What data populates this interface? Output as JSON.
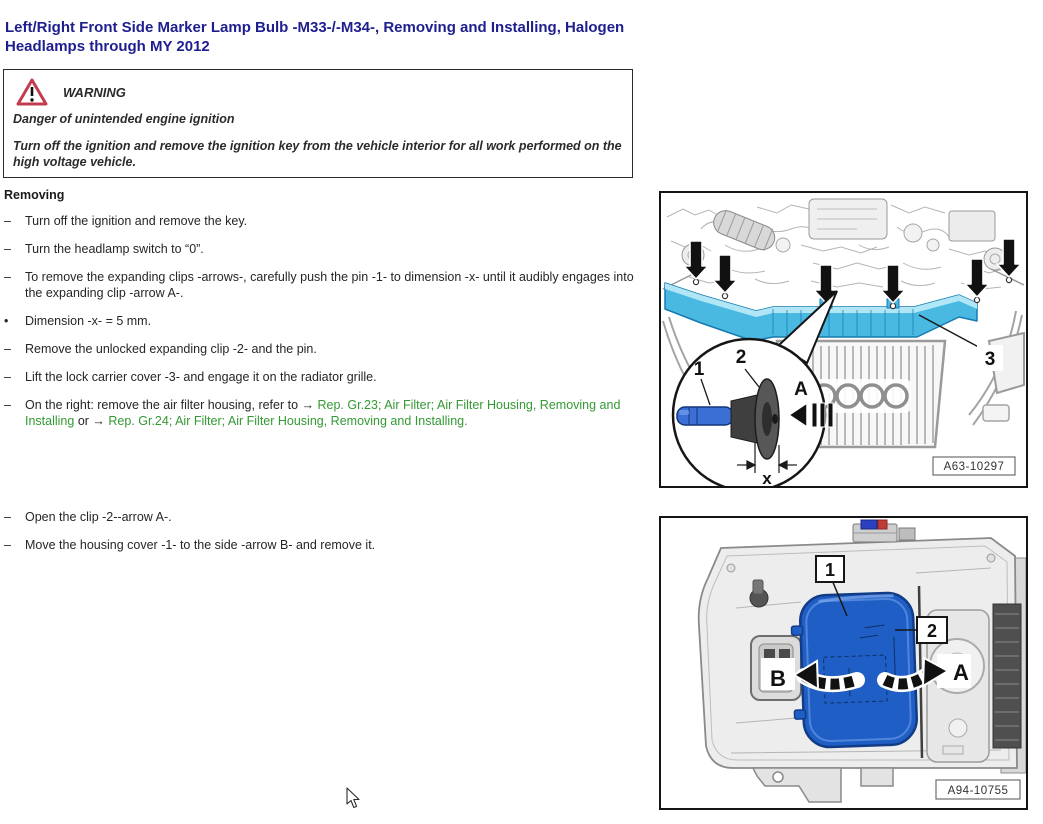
{
  "page": {
    "title": "Left/Right Front Side Marker Lamp Bulb -M33-/-M34-, Removing and Installing, Halogen Headlamps through MY 2012"
  },
  "warning": {
    "heading": "WARNING",
    "line1": "Danger of unintended engine ignition",
    "line2": "Turn off the ignition and remove the ignition key from the vehicle interior for all work performed on the high voltage vehicle."
  },
  "removing": {
    "heading": "Removing",
    "steps_part1": [
      {
        "bullet": "–",
        "segments": [
          {
            "text": "Turn off the ignition and remove the key.",
            "link": false
          }
        ]
      },
      {
        "bullet": "–",
        "segments": [
          {
            "text": "Turn the headlamp switch to “0”.",
            "link": false
          }
        ]
      },
      {
        "bullet": "–",
        "segments": [
          {
            "text": "To remove the expanding clips -arrows-, carefully push the pin -1- to dimension -x- until it audibly engages into the expanding clip -arrow A-.",
            "link": false
          }
        ]
      },
      {
        "bullet": "•",
        "segments": [
          {
            "text": "Dimension -x- = 5 mm.",
            "link": false
          }
        ]
      },
      {
        "bullet": "–",
        "segments": [
          {
            "text": "Remove the unlocked expanding clip -2- and the pin.",
            "link": false
          }
        ]
      },
      {
        "bullet": "–",
        "segments": [
          {
            "text": "Lift the lock carrier cover -3- and engage it on the radiator grille.",
            "link": false
          }
        ]
      },
      {
        "bullet": "–",
        "segments": [
          {
            "text": "On the right: remove the air filter housing, refer to → ",
            "link": false
          },
          {
            "text": "Rep. Gr.23; Air Filter; Air Filter Housing, Removing and Installing",
            "link": true
          },
          {
            "text": " or → ",
            "link": false
          },
          {
            "text": "Rep. Gr.24; Air Filter; Air Filter Housing, Removing and Installing.",
            "link": true
          }
        ]
      }
    ],
    "steps_part2": [
      {
        "bullet": "–",
        "segments": [
          {
            "text": "Open the clip -2--arrow A-.",
            "link": false
          }
        ]
      },
      {
        "bullet": "–",
        "segments": [
          {
            "text": "Move the housing cover -1- to the side -arrow B- and remove it.",
            "link": false
          }
        ]
      }
    ]
  },
  "figures": {
    "fig1": {
      "ref": "A63-10297",
      "pin": "1",
      "clip": "2",
      "cover": "3",
      "arrow": "A",
      "dimension": "x"
    },
    "fig2": {
      "ref": "A94-10755",
      "cover": "1",
      "clip": "2",
      "arrow_b": "B",
      "arrow_a": "A"
    }
  },
  "colors": {
    "heading_blue": "#1e1e8f",
    "link_green": "#339933",
    "warning_red": "#c23b4e",
    "highlight_cyan": "#49b9e2",
    "highlight_blue": "#1f5ec4"
  }
}
